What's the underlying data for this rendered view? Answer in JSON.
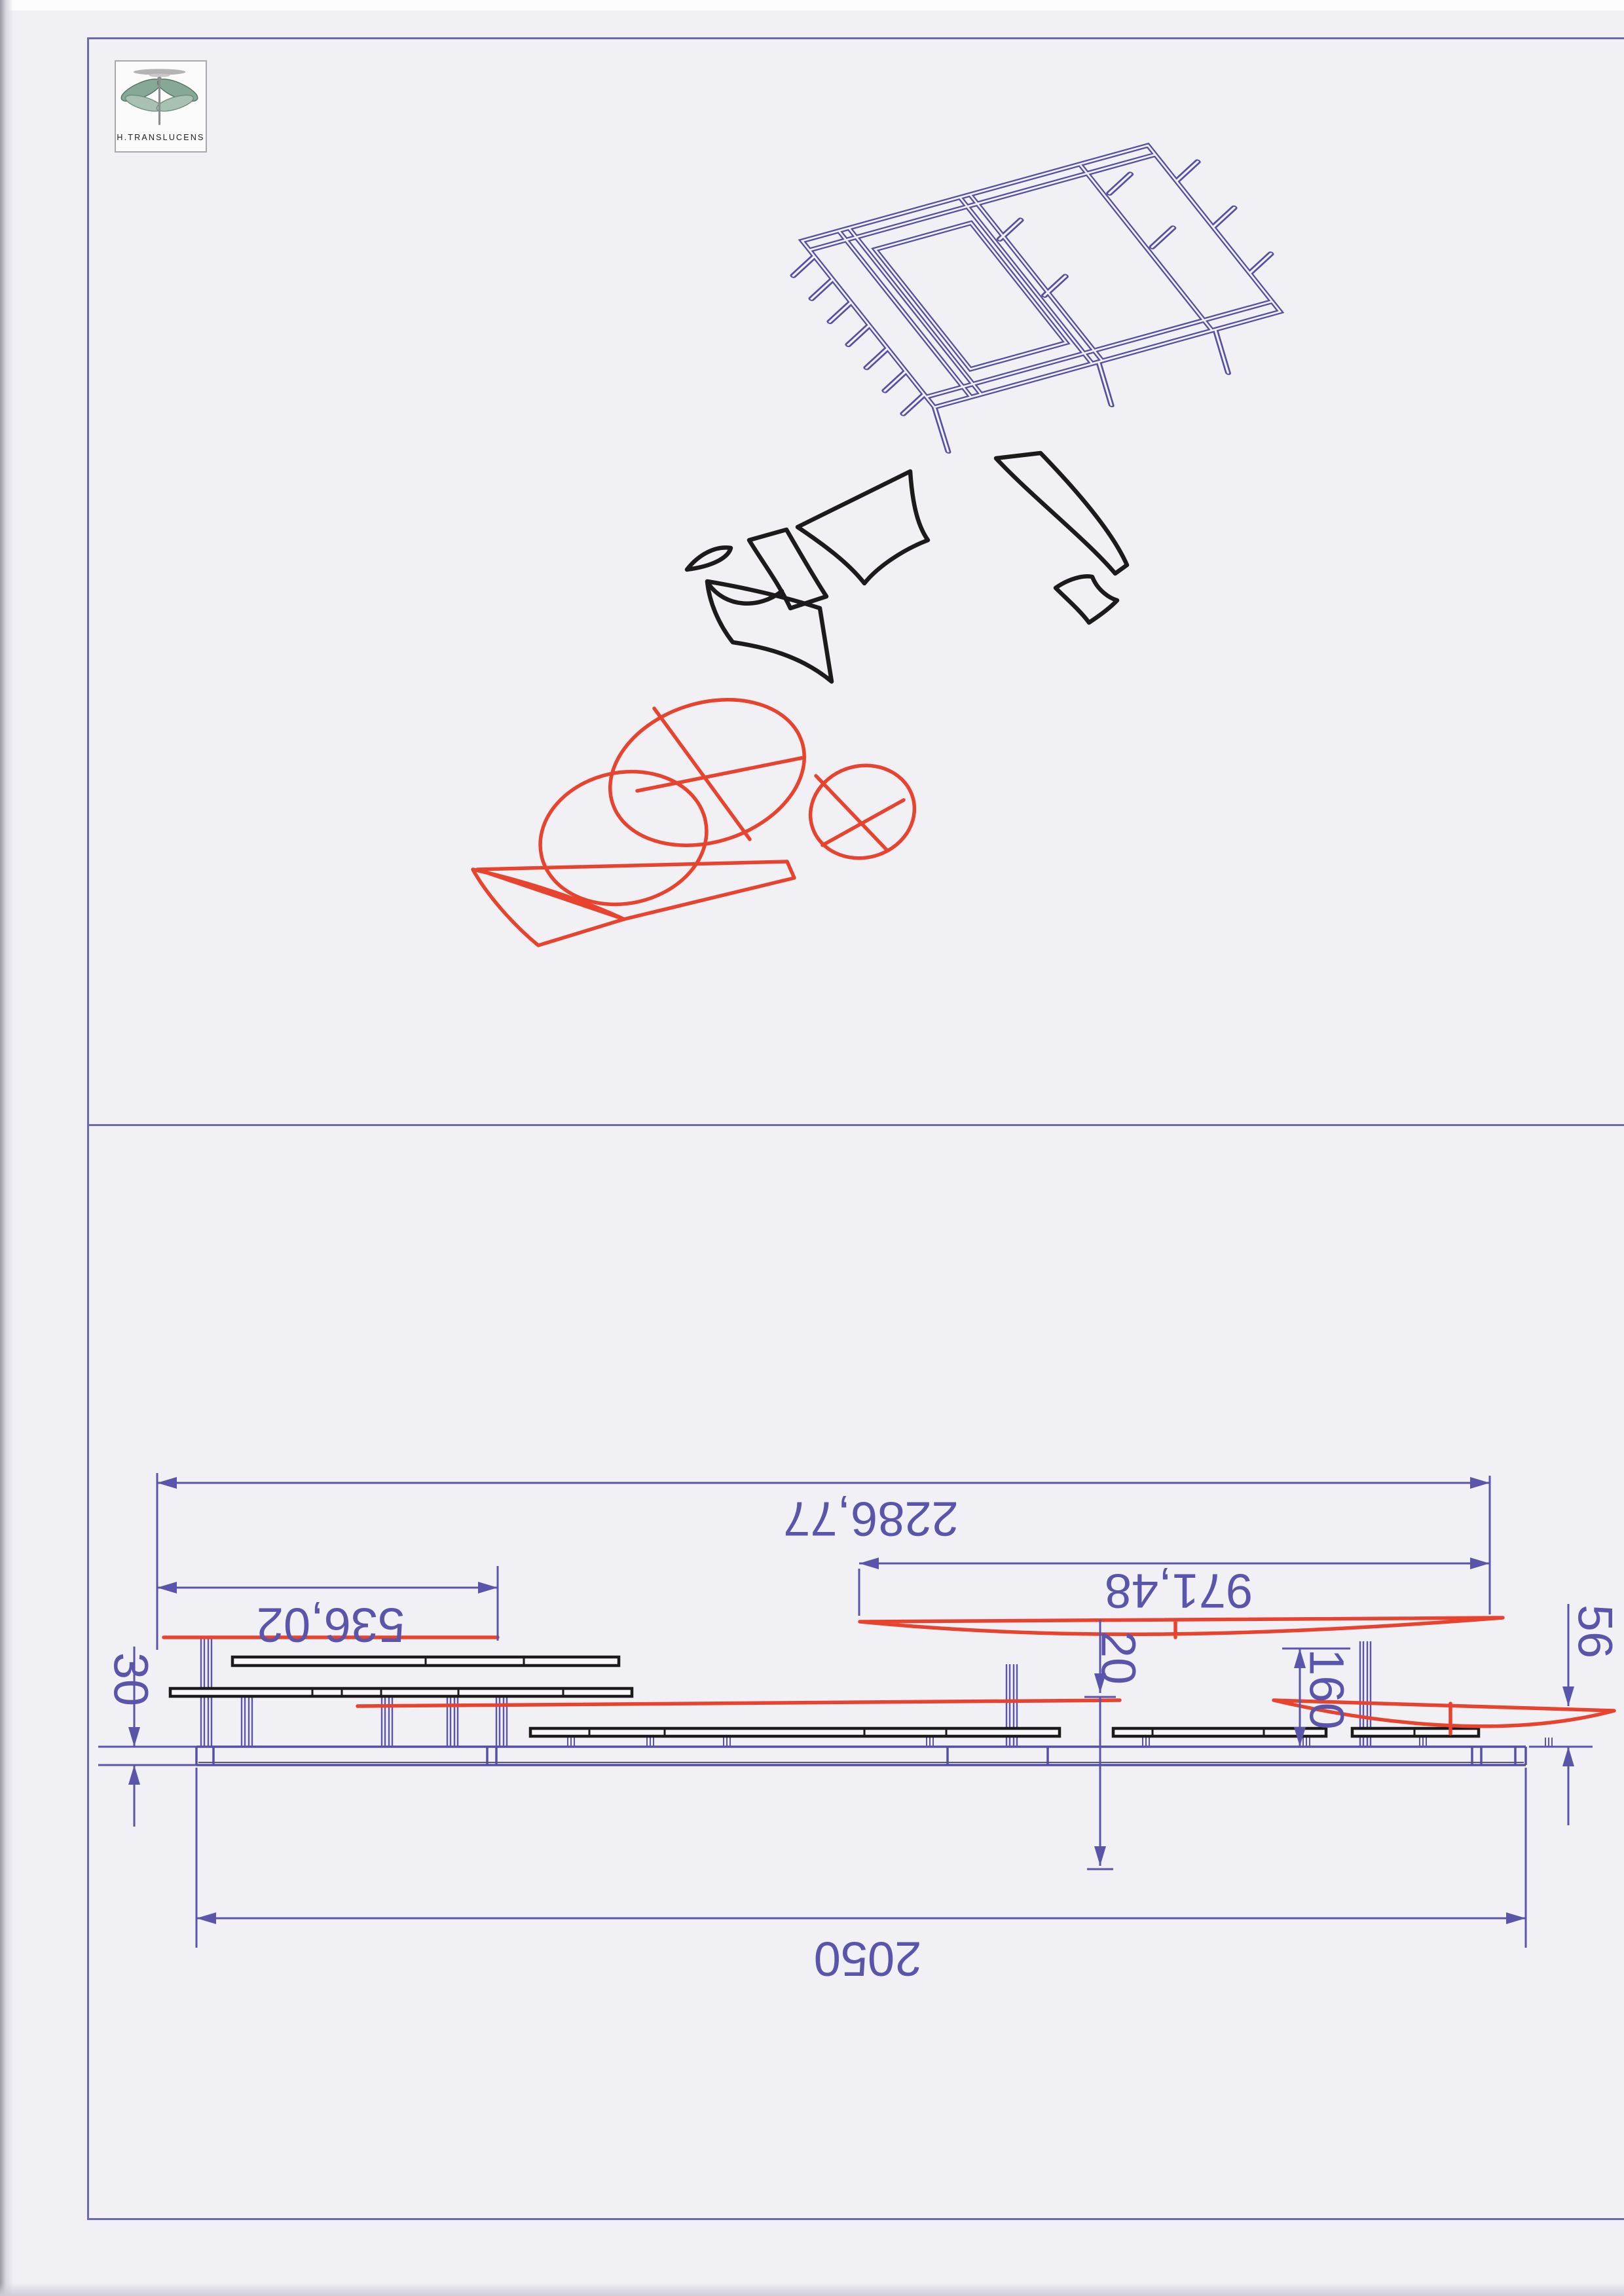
{
  "logo": {
    "label": "H.TRANSLUCENS"
  },
  "colors": {
    "sheet_border_blue": "#6b68b8",
    "structure_blue": "#564fa2",
    "dimension_blue": "#5a55ab",
    "canopy_red": "#e8432e",
    "pattern_black": "#1d1a1c",
    "paper": "#f1f0f5"
  },
  "elevation_dims": {
    "total_width": "2286,77",
    "left_span": "536,02",
    "right_span": "971,48",
    "platform_width": "2050",
    "platform_thickness": "30",
    "gap": "20",
    "canopy_height": "160",
    "right_offset": "56"
  }
}
